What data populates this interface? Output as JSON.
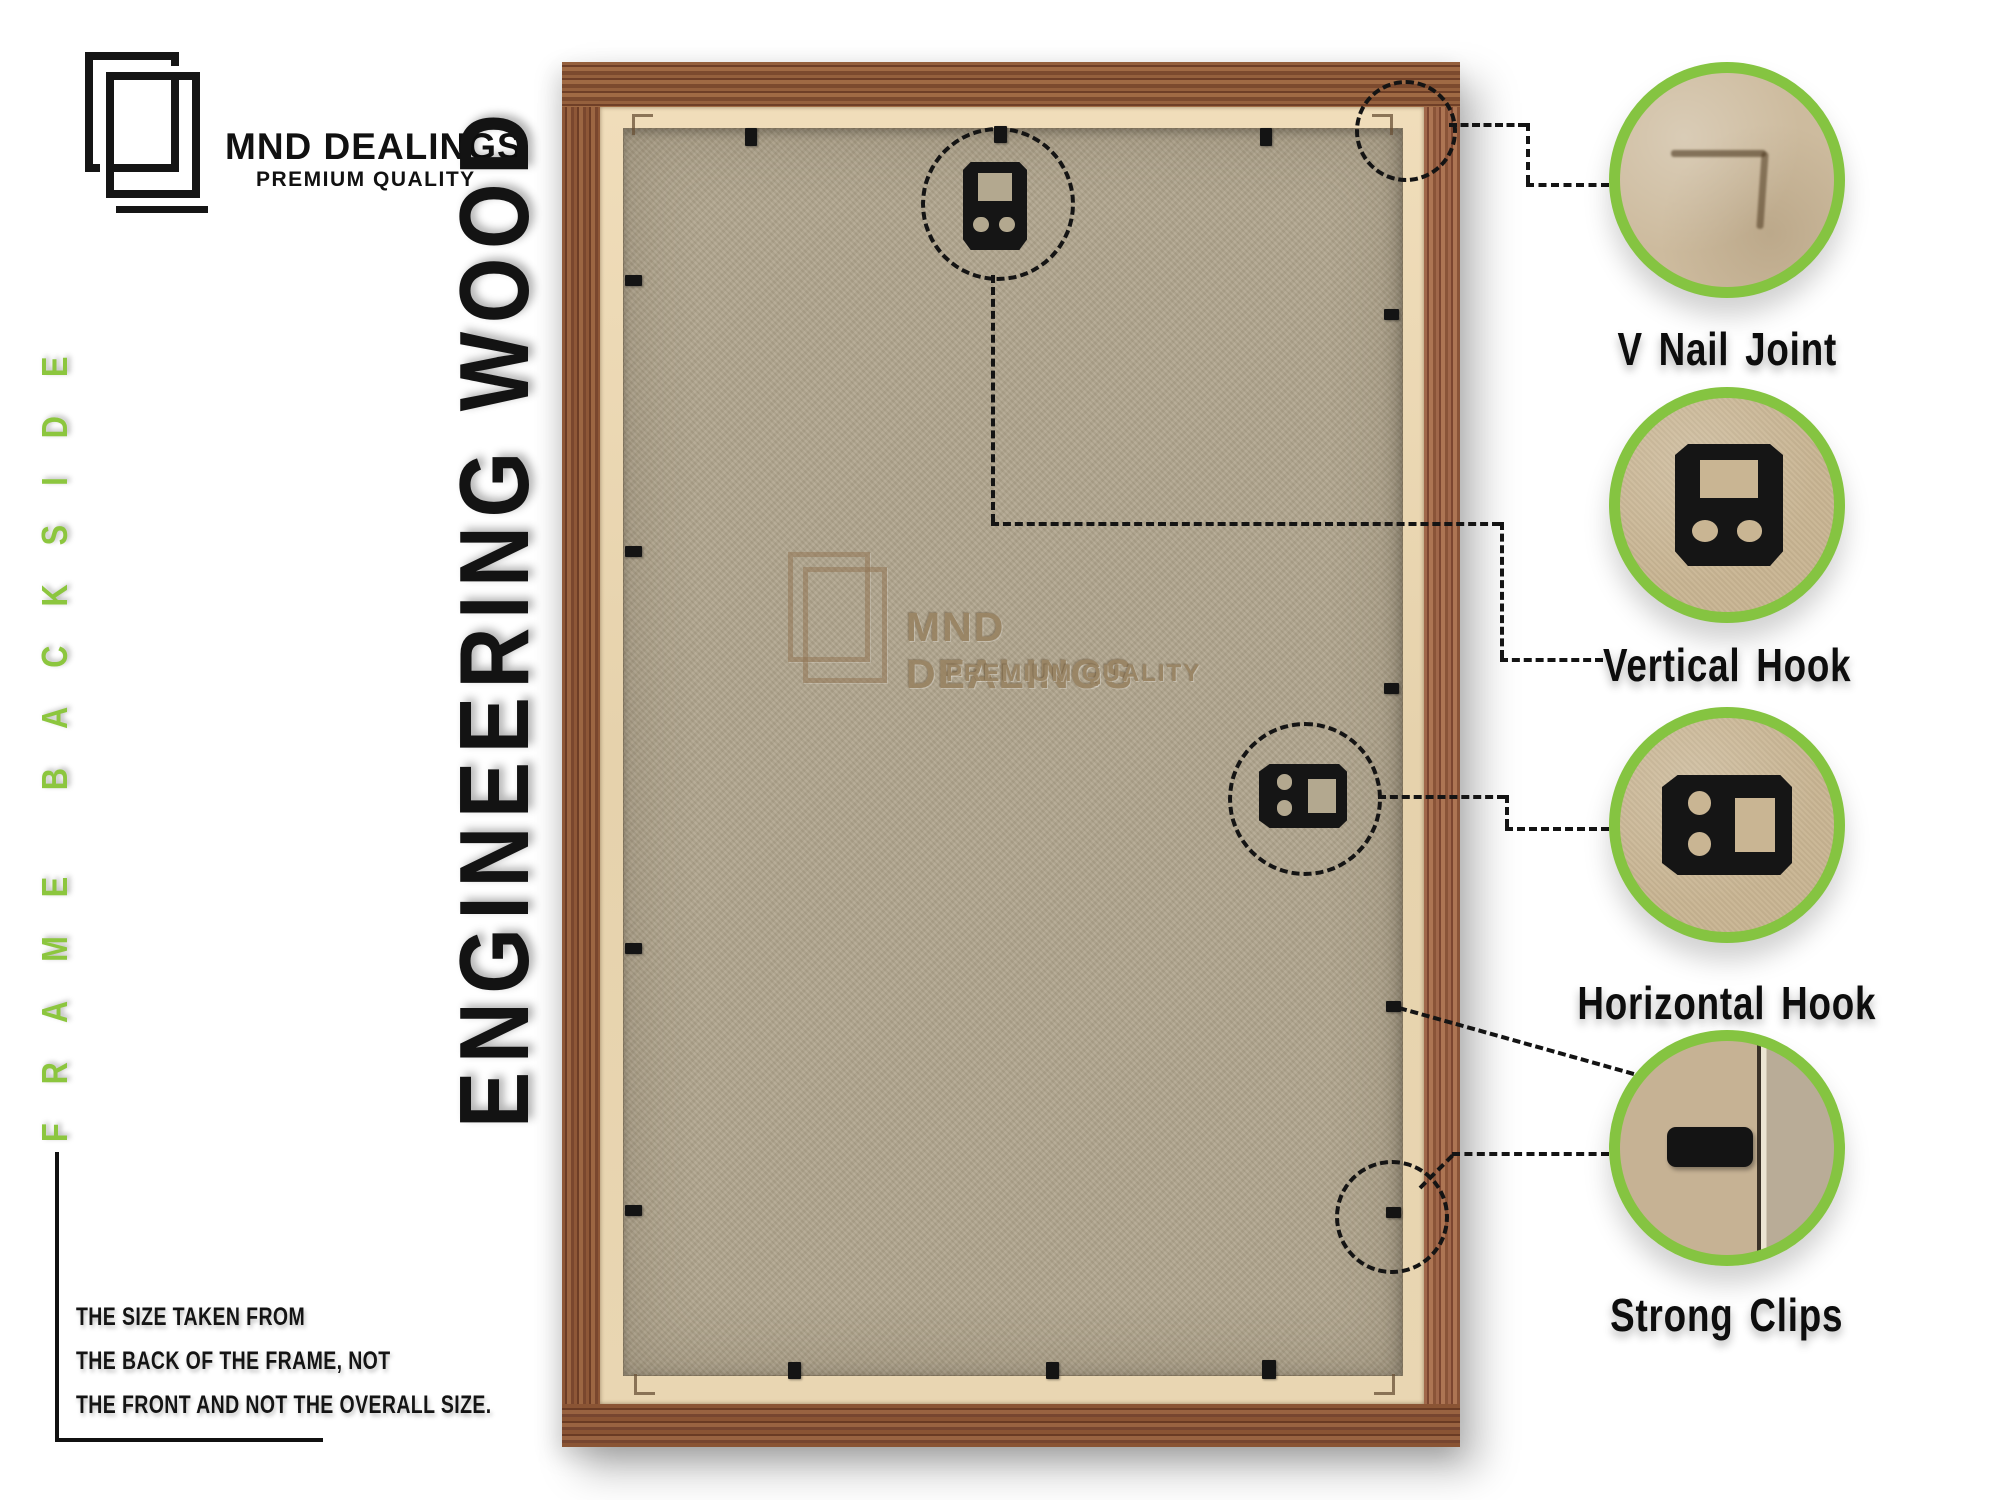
{
  "brand": {
    "name": "MND DEALINGS",
    "tagline": "PREMIUM QUALITY",
    "logo_icon": "overlapping-frames-icon"
  },
  "labels": {
    "side": "FRAME BACKSIDE",
    "material": "ENGINEERING WOOD"
  },
  "watermark": {
    "name": "MND DEALINGS",
    "tagline": "PREMIUM QUALITY"
  },
  "callouts": [
    {
      "label": "V Nail Joint",
      "icon": "v-nail-joint-photo"
    },
    {
      "label": "Vertical Hook",
      "icon": "vertical-hook-photo"
    },
    {
      "label": "Horizontal Hook",
      "icon": "horizontal-hook-photo"
    },
    {
      "label": "Strong Clips",
      "icon": "strong-clip-photo"
    }
  ],
  "note": {
    "lines": [
      "THE SIZE TAKEN FROM",
      "THE BACK OF THE FRAME, NOT",
      "THE FRONT AND NOT THE OVERALL SIZE."
    ]
  },
  "colors": {
    "accent_green": "#8CC63E",
    "ring_green": "#85C441",
    "wood": "#8A5434",
    "liner_beige": "#EAD7B2",
    "backboard": "#B1A68E",
    "hardware_black": "#151515",
    "watermark_brown": "#97815F",
    "text": "#111111"
  }
}
